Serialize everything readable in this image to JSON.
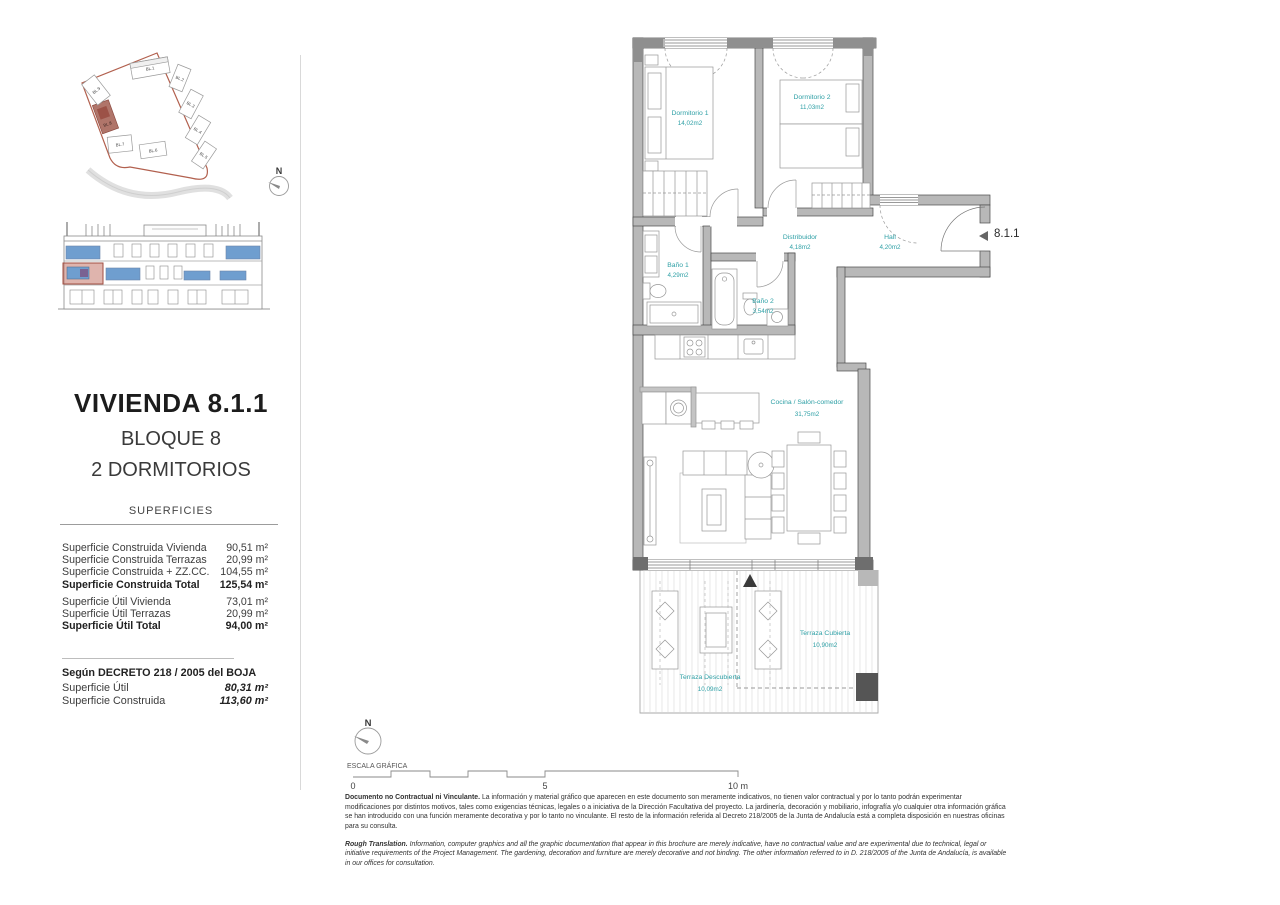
{
  "sidebar": {
    "title": "VIVIENDA 8.1.1",
    "block": "BLOQUE 8",
    "bedrooms": "2 DORMITORIOS",
    "superficies": {
      "header": "SUPERFICIES",
      "rows": [
        {
          "label": "Superficie Construida Vivienda",
          "value": "90,51 m²"
        },
        {
          "label": "Superficie Construida Terrazas",
          "value": "20,99 m²"
        },
        {
          "label": "Superficie Construida + ZZ.CC.",
          "value": "104,55 m²"
        },
        {
          "label": "Superficie Construida Total",
          "value": "125,54 m²"
        },
        {
          "label": "Superficie Útil Vivienda",
          "value": "73,01 m²"
        },
        {
          "label": "Superficie Útil Terrazas",
          "value": "20,99 m²"
        },
        {
          "label": "Superficie Útil Total",
          "value": "94,00 m²"
        }
      ]
    },
    "decreto": {
      "header": "Según DECRETO 218 / 2005 del BOJA",
      "rows": [
        {
          "label": "Superficie Útil",
          "value": "80,31 m²"
        },
        {
          "label": "Superficie Construida",
          "value": "113,60 m²"
        }
      ]
    },
    "site_plan": {
      "north_label": "N",
      "highlighted_block": "BL.8",
      "blocks": [
        "BL.1",
        "BL.2",
        "BL.3",
        "BL.4",
        "BL.5",
        "BL.6",
        "BL.7",
        "BL.8",
        "BL.9"
      ],
      "boundary_color": "#b2604e",
      "highlight_color": "#b0756a"
    },
    "elevation": {
      "window_color": "#6f9ecf",
      "highlight_color": "#c4766a"
    }
  },
  "plan": {
    "unit_label": "8.1.1",
    "label_color": "#2fa0a6",
    "rooms": [
      {
        "name": "Dormitorio 1",
        "area": "14,02m2"
      },
      {
        "name": "Dormitorio 2",
        "area": "11,03m2"
      },
      {
        "name": "Baño 1",
        "area": "4,29m2"
      },
      {
        "name": "Baño 2",
        "area": "3,54m2"
      },
      {
        "name": "Distribuidor",
        "area": "4,18m2"
      },
      {
        "name": "Hall",
        "area": "4,20m2"
      },
      {
        "name": "Cocina / Salón-comedor",
        "area": "31,75m2"
      },
      {
        "name": "Terraza Cubierta",
        "area": "10,90m2"
      },
      {
        "name": "Terraza Descubierta",
        "area": "10,09m2"
      }
    ]
  },
  "scale_bar": {
    "north_label": "N",
    "title": "ESCALA GRÁFICA",
    "tick_start": "0",
    "tick_mid": "5",
    "tick_end": "10 m"
  },
  "disclaimer": {
    "es_lead": "Documento no Contractual ni Vinculante.",
    "es_body": " La información y material gráfico que aparecen en este documento son meramente indicativos, no tienen valor contractual y por lo tanto podrán experimentar modificaciones por distintos motivos, tales como exigencias técnicas, legales o a iniciativa de la Dirección Facultativa del proyecto. La jardinería, decoración y mobiliario, infografía y/o cualquier otra información gráfica se han introducido con una función meramente decorativa y por lo tanto no vinculante. El resto de la información referida al Decreto 218/2005 de la Junta de Andalucía está a completa disposición en nuestras oficinas para su consulta.",
    "en_lead": "Rough Translation.",
    "en_body": " Information, computer graphics and all the graphic documentation that appear in this brochure are merely indicative, have no contractual value and are experimental due to technical, legal or initiative requirements of the Project Management. The gardening, decoration and furniture are merely decorative and not binding. The other information referred to in D. 218/2005 of the Junta de Andalucía, is available in our offices for consultation."
  }
}
